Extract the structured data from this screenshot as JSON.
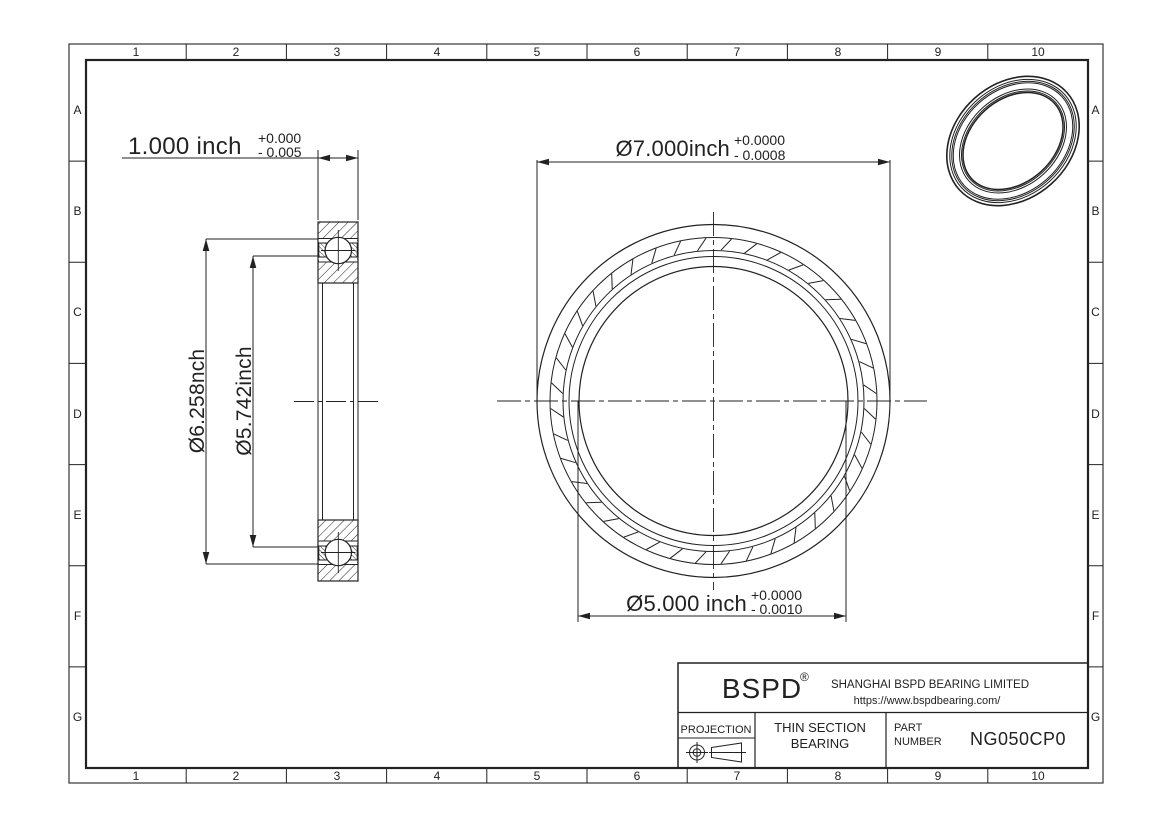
{
  "colors": {
    "line": "#222222",
    "background": "#ffffff"
  },
  "grid": {
    "columns": [
      "1",
      "2",
      "3",
      "4",
      "5",
      "6",
      "7",
      "8",
      "9",
      "10"
    ],
    "rows": [
      "A",
      "B",
      "C",
      "D",
      "E",
      "F",
      "G"
    ]
  },
  "dimensions": {
    "width": {
      "label": "1.000 inch",
      "tol_plus": "+0.000",
      "tol_minus": "- 0.005"
    },
    "outer_diameter": {
      "label": "Ø7.000inch",
      "tol_plus": "+0.0000",
      "tol_minus": "- 0.0008"
    },
    "bore_diameter": {
      "label": "Ø5.000 inch",
      "tol_plus": "+0.0000",
      "tol_minus": "- 0.0010"
    },
    "outer_race_diameter": "Ø6.258nch",
    "inner_race_diameter": "Ø5.742inch"
  },
  "title_block": {
    "brand": "BSPD",
    "registered_mark": "®",
    "company": "SHANGHAI BSPD BEARING LIMITED",
    "website": "https://www.bspdbearing.com/",
    "projection_label": "PROJECTION",
    "product_line1": "THIN SECTION",
    "product_line2": "BEARING",
    "part_label_line1": "PART",
    "part_label_line2": "NUMBER",
    "part_number": "NG050CP0"
  }
}
